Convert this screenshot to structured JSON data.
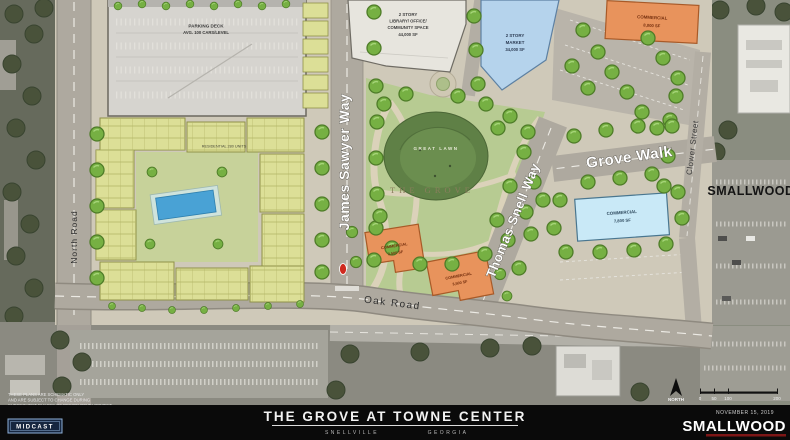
{
  "plan": {
    "buildings": {
      "parking_deck": {
        "name": "PARKING DECK",
        "capacity": "AVG. 100 CARS/LEVEL"
      },
      "library": {
        "l1": "2 STORY",
        "l2": "LIBRARY/ OFFICE/",
        "l3": "COMMUNITY SPACE",
        "l4": "44,000 SF"
      },
      "market": {
        "l1": "2 STORY",
        "l2": "MARKET",
        "l3": "34,000 SF"
      },
      "commercial_ne": {
        "l1": "COMMERCIAL",
        "l2": "8,000 SF"
      },
      "commercial_east": {
        "l1": "COMMERCIAL",
        "l2": "7,800 SF"
      },
      "commercial_south_a": {
        "l1": "COMMERCIAL",
        "l2": "3,500 SF"
      },
      "commercial_south_b": {
        "l1": "COMMERCIAL",
        "l2": "3,500 SF"
      },
      "residential": {
        "label": "RESIDENTIAL 280 UNITS"
      }
    },
    "park": {
      "name": "THE GROVE",
      "lawn_label": "GREAT LAWN"
    },
    "streets": {
      "north_road": "North Road",
      "james_sawyer": "James Sawyer Way",
      "thomas_snell": "Thomas Snell Way",
      "grove_walk": "Grove Walk",
      "oak_road": "Oak Road",
      "clower_street": "Clower Street"
    },
    "watermark": "SMALLWOOD"
  },
  "annotations": {
    "north_label": "NORTH",
    "scale_ticks": [
      "0",
      "50",
      "100",
      "200"
    ],
    "date": "NOVEMBER 15, 2019",
    "disclaimer_l1": "THESE PLANS ARE SCHEMATIC ONLY",
    "disclaimer_l2": "AND ARE SUBJECT TO CHANGE DURING",
    "disclaimer_l3": "SUBSEQUENT PHASES OF DESIGN DEVELOPMENT"
  },
  "footer": {
    "title": "THE GROVE AT TOWNE CENTER",
    "subtitle_left": "SNELLVILLE",
    "subtitle_right": "GEORGIA",
    "firm_left": "MIDCAST",
    "firm_right": "SMALLWOOD"
  },
  "colors": {
    "commercial_orange": "#E8935C",
    "market_blue": "#B5D3EC",
    "commercial_light_blue": "#C9E9F7",
    "residential_yellow": "#DCDF97",
    "park_green": "#B7CB92",
    "lawn_dark_green": "#5F8046",
    "road_gray": "#AEA99F",
    "pool_blue": "#49A2D5",
    "signal_red": "#CF2A1F",
    "footer_black": "#0A0A0A"
  }
}
